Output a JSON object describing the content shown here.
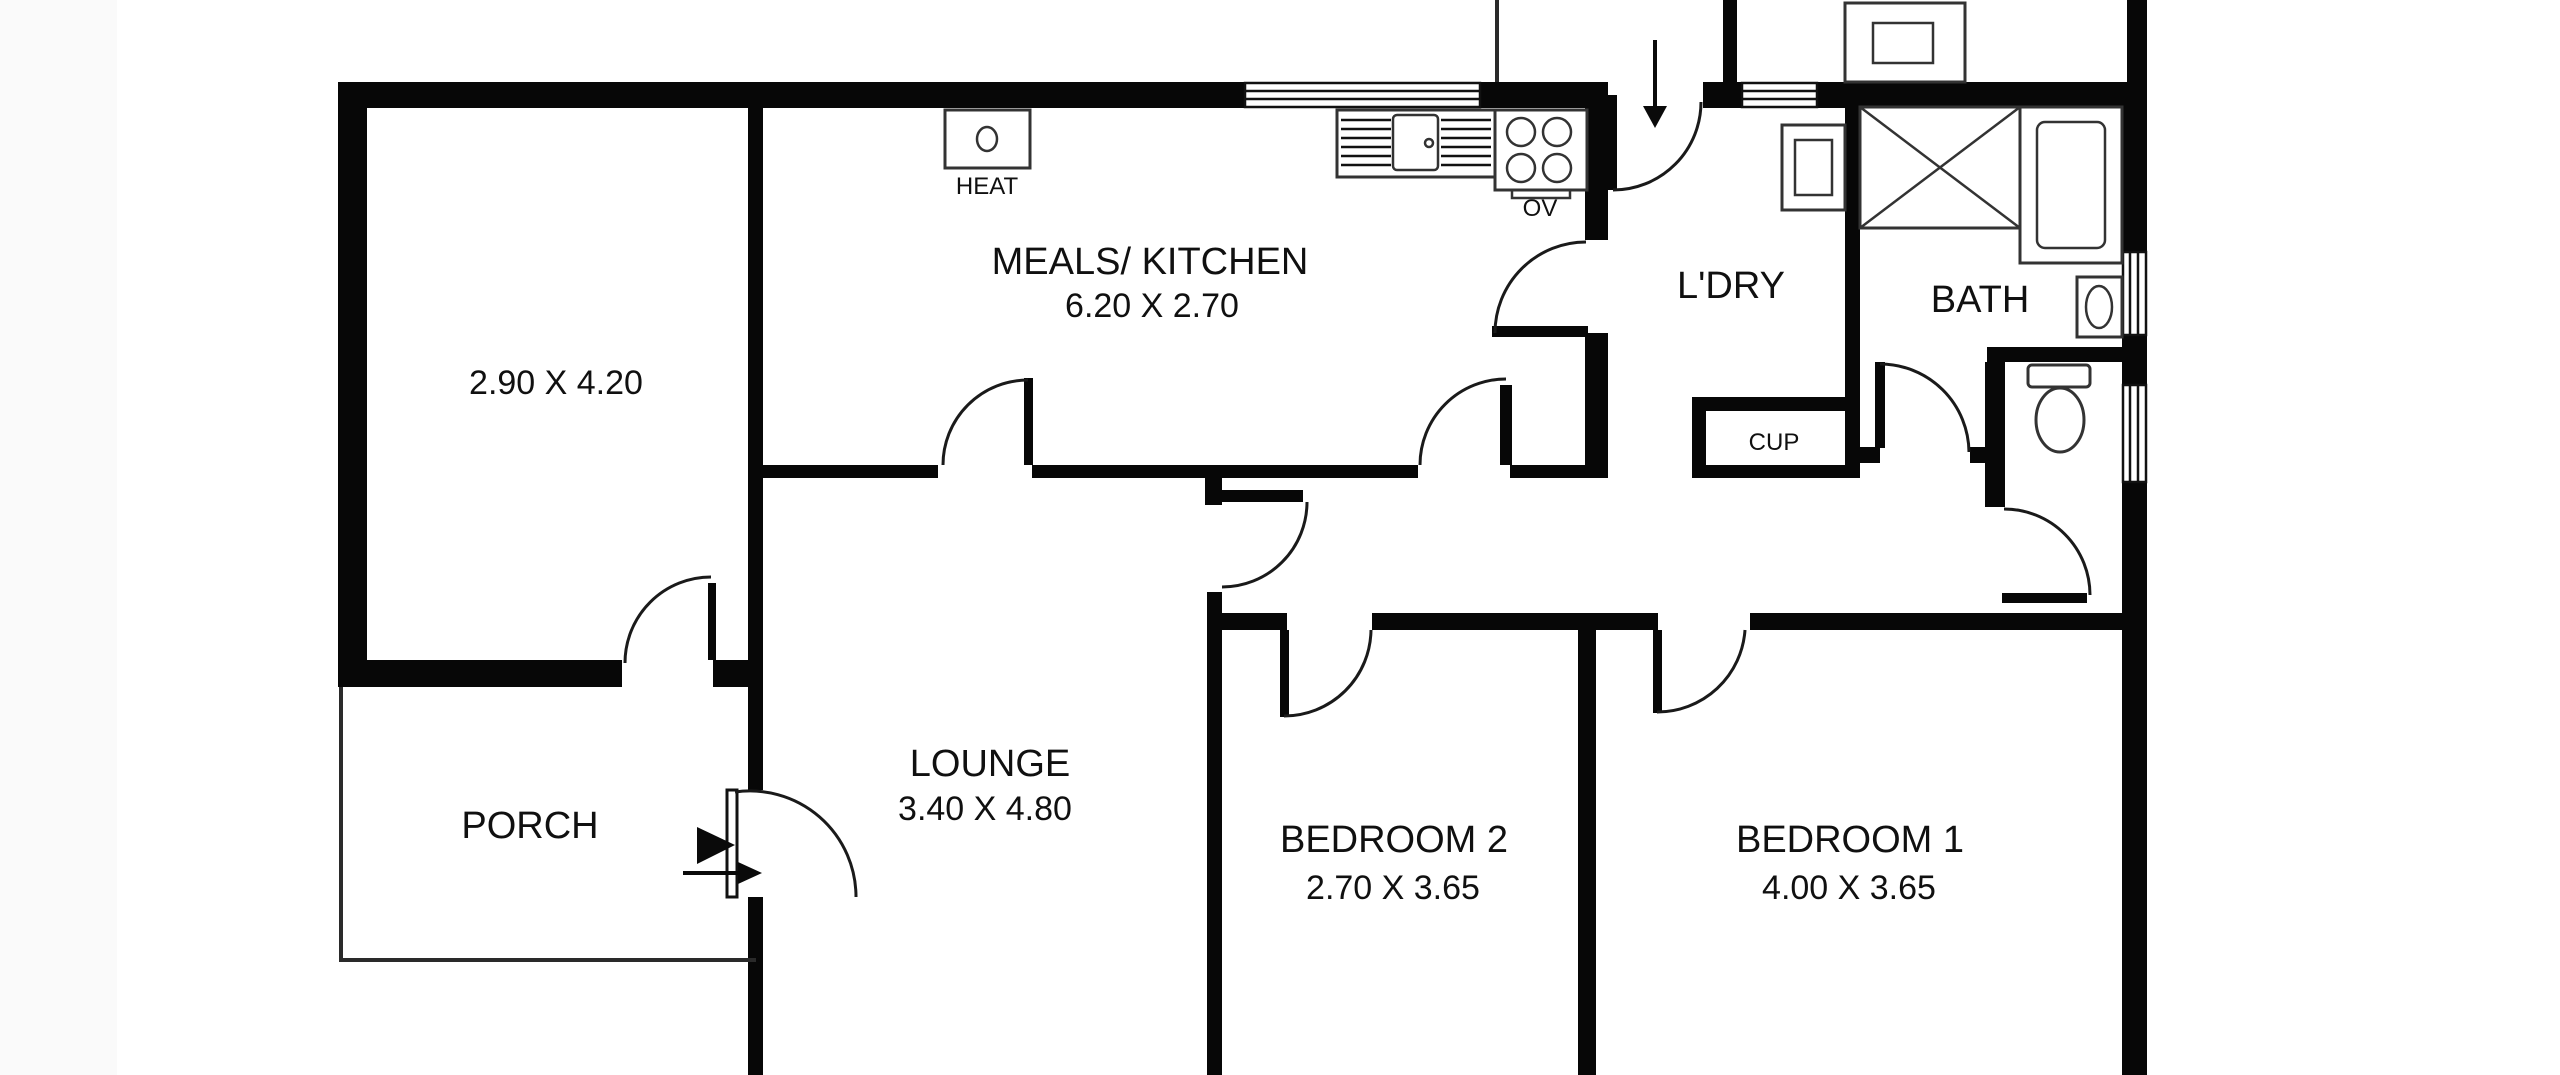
{
  "page": {
    "background": "#ffffff",
    "wall_color": "#070707",
    "line_color": "#1a1a1a"
  },
  "floorplan": {
    "rooms": [
      {
        "id": "front-room",
        "name": "",
        "dims": "2.90 X 4.20"
      },
      {
        "id": "meals-kitchen",
        "name": "MEALS/ KITCHEN",
        "dims": "6.20 X 2.70"
      },
      {
        "id": "laundry",
        "name": "L'DRY",
        "dims": ""
      },
      {
        "id": "bath",
        "name": "BATH",
        "dims": ""
      },
      {
        "id": "cupboard",
        "name": "CUP",
        "dims": ""
      },
      {
        "id": "porch",
        "name": "PORCH",
        "dims": ""
      },
      {
        "id": "lounge",
        "name": "LOUNGE",
        "dims": "3.40 X 4.80"
      },
      {
        "id": "bedroom-2",
        "name": "BEDROOM 2",
        "dims": "2.70 X 3.65"
      },
      {
        "id": "bedroom-1",
        "name": "BEDROOM 1",
        "dims": "4.00 X 3.65"
      }
    ],
    "fixture_labels": {
      "heater": "HEAT",
      "oven": "OV"
    }
  }
}
